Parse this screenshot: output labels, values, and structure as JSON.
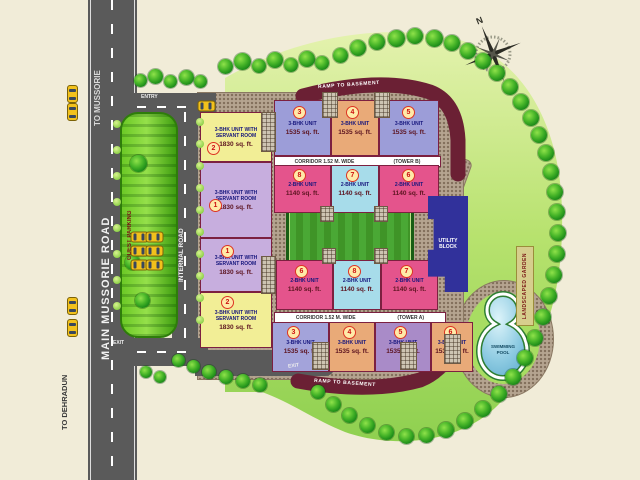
{
  "plan": {
    "roads": {
      "main_road": "MAIN MUSSORIE ROAD",
      "to_mussorie": "TO MUSSORIE",
      "to_dehradun": "TO DEHRADUN",
      "internal_road": "INTERNAL ROAD",
      "entry_label": "ENTRY",
      "exit_label": "EXIT",
      "exit_label_2": "EXIT",
      "ramp_top_label": "RAMP TO BASEMENT",
      "ramp_bottom_label": "RAMP TO BASEMENT"
    },
    "areas": {
      "guest_parking": "GUEST PARKING",
      "park": "PARK",
      "utility_block": "UTILITY BLOCK",
      "swimming_pool_line1": "SWIMMING",
      "swimming_pool_line2": "POOL",
      "landscaped_garden": "LANDSCAPED GARDEN"
    },
    "compass_north": "N",
    "tower_b": {
      "corridor_label": "CORRIDOR 1.52 M. WIDE",
      "tower_label": "(TOWER B)",
      "left_units": [
        {
          "num": "2",
          "type": "3-BHK UNIT WITH SERVANT ROOM",
          "area": "1830 sq. ft."
        },
        {
          "num": "1",
          "type": "3-BHK UNIT WITH SERVANT ROOM",
          "area": "1830 sq. ft."
        }
      ],
      "top_units": [
        {
          "num": "3",
          "type": "3-BHK UNIT",
          "area": "1535 sq. ft."
        },
        {
          "num": "4",
          "type": "3-BHK UNIT",
          "area": "1535 sq. ft."
        },
        {
          "num": "5",
          "type": "3-BHK UNIT",
          "area": "1535 sq. ft."
        }
      ],
      "bottom_units": [
        {
          "num": "8",
          "type": "2-BHK UNIT",
          "area": "1140 sq. ft."
        },
        {
          "num": "7",
          "type": "2-BHK UNIT",
          "area": "1140 sq. ft."
        },
        {
          "num": "6",
          "type": "2-BHK UNIT",
          "area": "1140 sq. ft."
        }
      ]
    },
    "tower_a": {
      "corridor_label": "CORRIDOR 1.52 M. WIDE",
      "tower_label": "(TOWER A)",
      "left_units": [
        {
          "num": "1",
          "type": "3-BHK UNIT WITH SERVANT ROOM",
          "area": "1830 sq. ft."
        },
        {
          "num": "2",
          "type": "3-BHK UNIT WITH SERVANT ROOM",
          "area": "1830 sq. ft."
        }
      ],
      "top_units": [
        {
          "num": "6",
          "type": "2-BHK UNIT",
          "area": "1140 sq. ft."
        },
        {
          "num": "8",
          "type": "2-BHK UNIT",
          "area": "1140 sq. ft."
        },
        {
          "num": "7",
          "type": "2-BHK UNIT",
          "area": "1140 sq. ft."
        }
      ],
      "bottom_units": [
        {
          "num": "3",
          "type": "3-BHK UNIT",
          "area": "1535 sq. ft."
        },
        {
          "num": "4",
          "type": "3-BHK UNIT",
          "area": "1535 sq. ft."
        },
        {
          "num": "5",
          "type": "3-BHK UNIT",
          "area": "1535 sq. ft."
        },
        {
          "num": "6",
          "type": "3-BHK UNIT",
          "area": "1535 sq. ft."
        }
      ]
    },
    "colors": {
      "road": "#5a5a5a",
      "pavement": "#b5a490",
      "lawn": "#9ed65a",
      "ramp_maroon": "#6b2034",
      "pool_water": "#7cc4de",
      "utility_navy": "#31319b",
      "park_green": "#3f9e2e",
      "unit_pink": "#e4548c",
      "unit_blue": "#9c9dd8",
      "unit_orange": "#e9aa78",
      "unit_cyan": "#a7dcea",
      "unit_yellow": "#f2ee96",
      "unit_lavender": "#c7aede"
    }
  }
}
